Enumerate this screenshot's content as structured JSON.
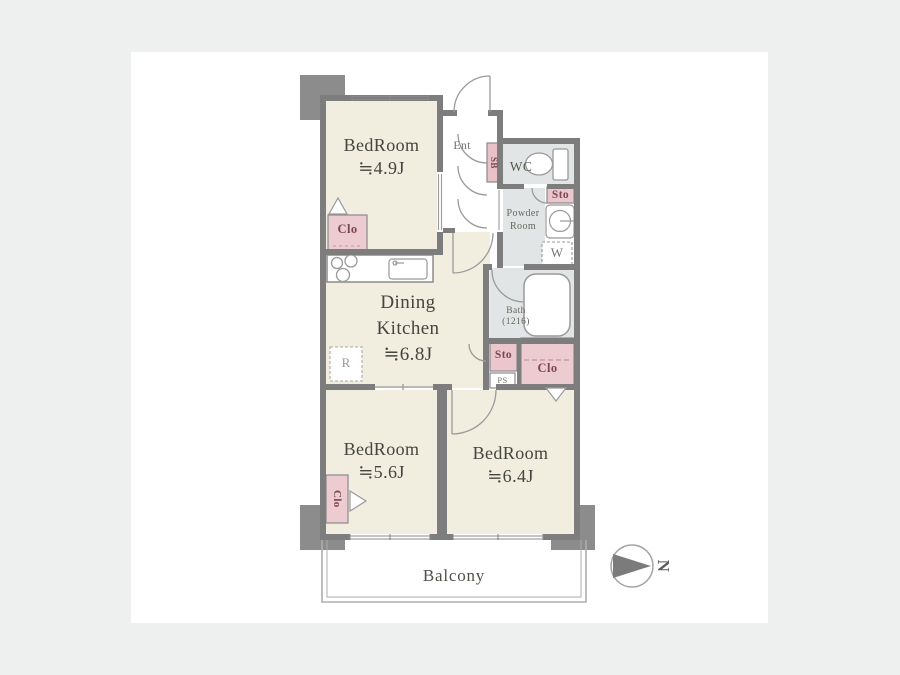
{
  "window": {
    "background": "#eef0f0",
    "canvas_background": "#ffffff"
  },
  "palette": {
    "room_fill": "#f1eee0",
    "wet_room_fill": "#e2e5e5",
    "closet_fill": "#edccd1",
    "shoe_box_fill": "#e9c2c9",
    "wall": "#7d7d7d",
    "pillar": "#8c8c8c",
    "room_label_text": "#45453f",
    "closet_label_text": "#7c4650",
    "fixture_stroke": "#999999"
  },
  "rooms": {
    "bedroom_small": {
      "name": "BedRoom",
      "size": "≒4.9J"
    },
    "dining_kitchen": {
      "name_line1": "Dining",
      "name_line2": "Kitchen",
      "size": "≒6.8J"
    },
    "bedroom_mid": {
      "name": "BedRoom",
      "size": "≒5.6J"
    },
    "bedroom_large": {
      "name": "BedRoom",
      "size": "≒6.4J"
    },
    "balcony": {
      "name": "Balcony"
    },
    "entrance": {
      "name": "Ent"
    },
    "wc": {
      "name": "WC"
    },
    "powder_room": {
      "name_line1": "Powder",
      "name_line2": "Room"
    },
    "bath": {
      "name": "Bath",
      "size": "(1216)"
    }
  },
  "fixtures": {
    "shoe_box": "SB",
    "storage_by_wc": "Sto",
    "storage_by_kitchen": "Sto",
    "pipe_space": "PS",
    "closet_bedroom_small": "Clo",
    "closet_bedroom_mid": "Clo",
    "closet_bedroom_large": "Clo",
    "washer_space": "W",
    "refrigerator_space": "R"
  },
  "compass": {
    "label": "N"
  }
}
